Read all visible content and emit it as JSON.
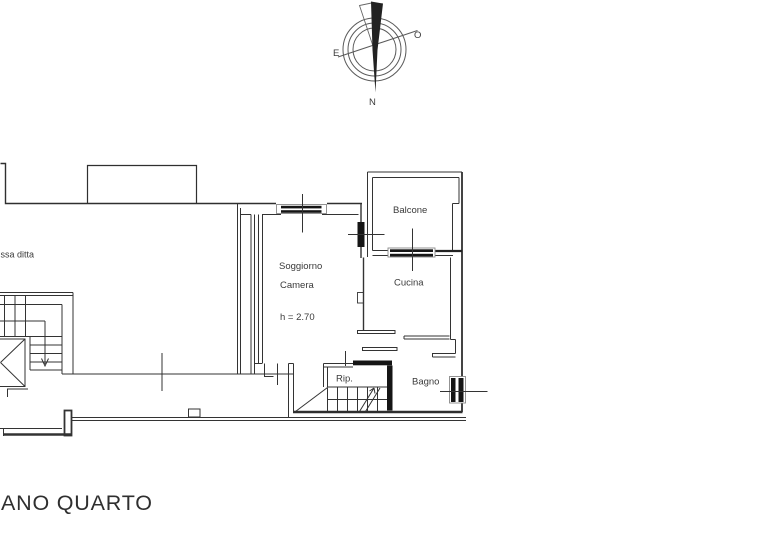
{
  "page": {
    "background": "#ffffff",
    "line_color": "#333333",
    "fixture_color": "#151515"
  },
  "compass": {
    "north_label": "N",
    "east_label": "E",
    "west_label": "O"
  },
  "plan": {
    "annotations": {
      "adjacent_property": "ssa ditta"
    },
    "rooms": [
      {
        "id": "balcone",
        "label": "Balcone"
      },
      {
        "id": "soggiorno",
        "label_line1": "Soggiorno",
        "label_line2": "Camera",
        "height_note": "h = 2.70"
      },
      {
        "id": "cucina",
        "label": "Cucina"
      },
      {
        "id": "rip",
        "label": "Rip."
      },
      {
        "id": "bagno",
        "label": "Bagno"
      }
    ]
  },
  "title": {
    "text": "ANO QUARTO"
  }
}
